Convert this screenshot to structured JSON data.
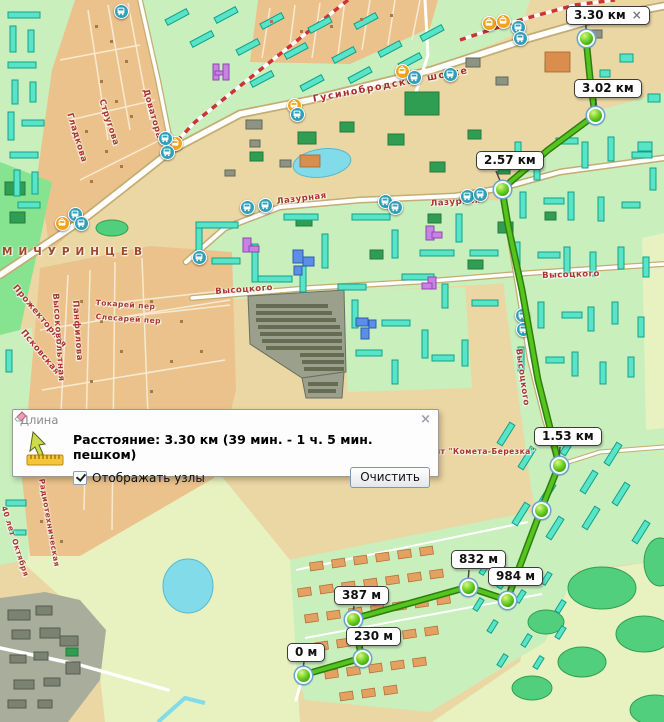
{
  "app": {
    "type": "map-distance-measure-tool"
  },
  "measure_dialog": {
    "title": "Длина",
    "close_glyph": "x",
    "distance_text": "Расстояние: 3.30 км (39 мин. - 1 ч. 5 мин. пешком)",
    "nodes_checkbox_label": "Отображать узлы",
    "nodes_checkbox_checked": true,
    "clear_button_label": "Очистить"
  },
  "route_markers": {
    "m0": "0 м",
    "m230": "230 м",
    "m387": "387 м",
    "m832": "832 м",
    "m984": "984 м",
    "m1_53": "1.53 км",
    "m2_57": "2.57 км",
    "m3_02": "3.02 км",
    "m3_30": "3.30 км",
    "final_close_glyph": "x"
  },
  "streets": {
    "gusinobrodskoe_shosse": "Гусинобродское шоссе",
    "lazurnaya": "Лазурная",
    "vysotskogo": "Высоцкого",
    "michurintsev": "МИЧУРИНЦЕВ",
    "dovatora": "Доватора",
    "strugova": "Стругова",
    "gladkova": "Гладкова",
    "prozhektornaya": "Прожекторная",
    "pskovskaya": "Псковская",
    "vysokovoltnaya": "Высоковольтная",
    "panfilova": "Панфилова",
    "tokarev_per": "Токарей пер",
    "slesarev_per": "Слесарей пер",
    "snt_kometa": "снт \"Комета-Березка\"",
    "radiotehnicheskaya": "Радиотехническая",
    "sorok_let_oktyabrya": "40 лет Октября"
  },
  "icons": {
    "bus_stop": "bus-icon",
    "tram_stop": "tram-icon",
    "ruler": "ruler-icon",
    "cursor": "cursor-arrow-icon",
    "eraser": "eraser-icon",
    "close": "close-icon"
  },
  "colors": {
    "route_green": "#3fae1f",
    "node_green": "#55c518",
    "marker_label_bg": "#ffffff",
    "street_text": "#a8352b",
    "water": "#82dbe8",
    "residential": "#c9efbd",
    "private_sector": "#ecc28c",
    "field": "#e7f2c0",
    "park_green": "#86e390",
    "industrial_gray": "#a9ae9c",
    "building_teal": "#58e4c6",
    "building_orange": "#e3a262",
    "tram_line_red": "#cc3333",
    "bus_icon_bg": "#2fa0b8",
    "tram_icon_bg": "#f2a41c",
    "base_tan": "#ebd7a3"
  }
}
